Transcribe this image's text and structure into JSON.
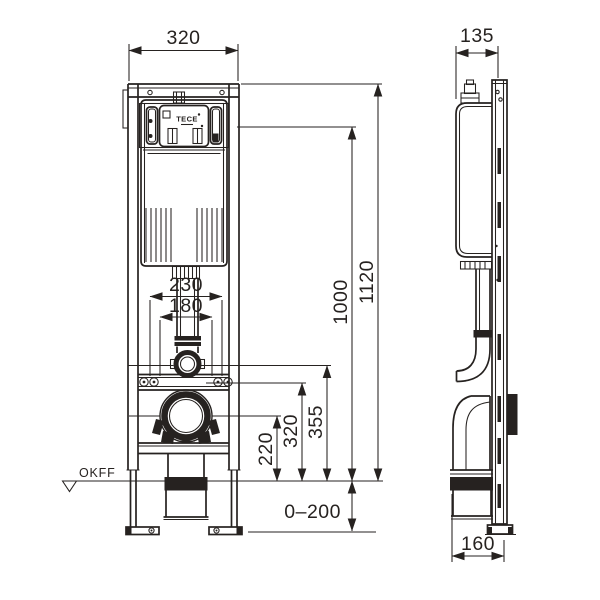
{
  "drawing": {
    "brand_logo": "TECE",
    "floor_datum_label": "OKFF",
    "front_view": {
      "frame_width": "320",
      "fixing_spacing_outer": "230",
      "fixing_spacing_inner": "180",
      "outlet_height": "220",
      "fixing_height": "320",
      "flush_bend_height": "355",
      "actuator_height": "1000",
      "frame_height": "1120",
      "foot_adjustment": "0–200"
    },
    "side_view": {
      "frame_depth": "135",
      "base_depth": "160"
    }
  }
}
